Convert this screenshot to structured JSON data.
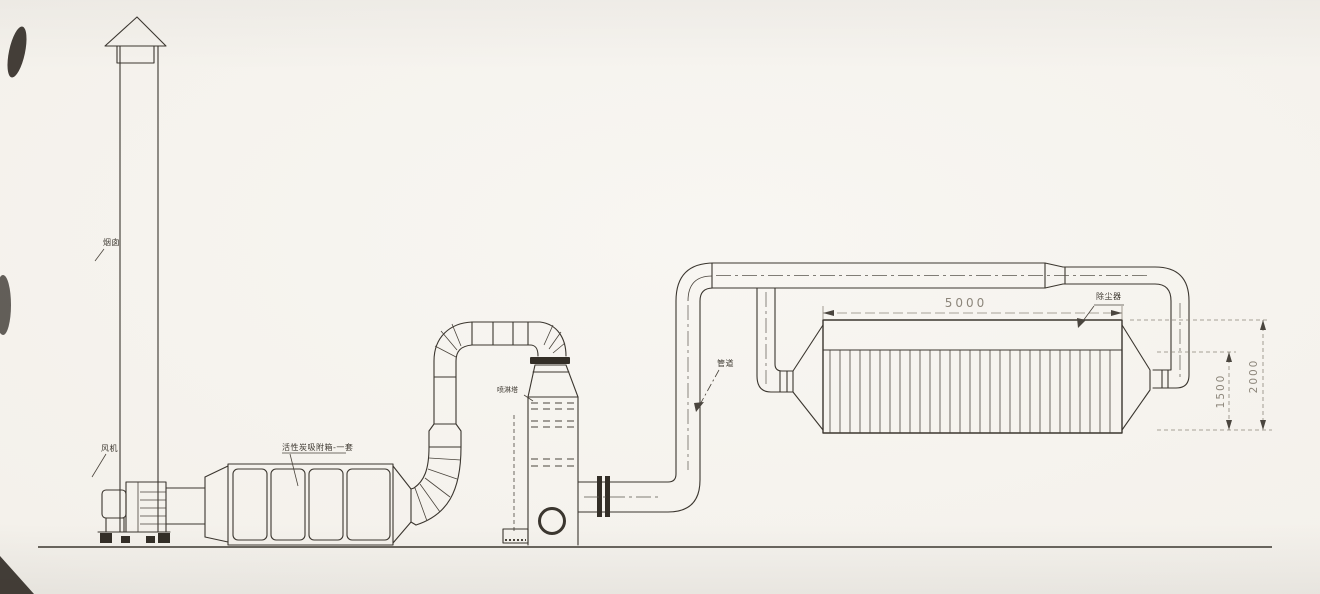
{
  "drawing": {
    "labels": {
      "chimney": "烟囱",
      "fan": "风机",
      "carbon_box": "活性炭吸附箱-一套",
      "spray_tower": "喷淋塔",
      "duct": "管道",
      "dust_collector": "除尘器"
    },
    "dimensions": {
      "collector_length_mm": "5000",
      "bag_section_height_mm": "1500",
      "collector_total_height_mm": "2000"
    },
    "colors": {
      "line": "#3b362f",
      "dim_line": "#8d867b",
      "label_text": "#3f3a32",
      "paper": "#f4f1eb"
    }
  }
}
